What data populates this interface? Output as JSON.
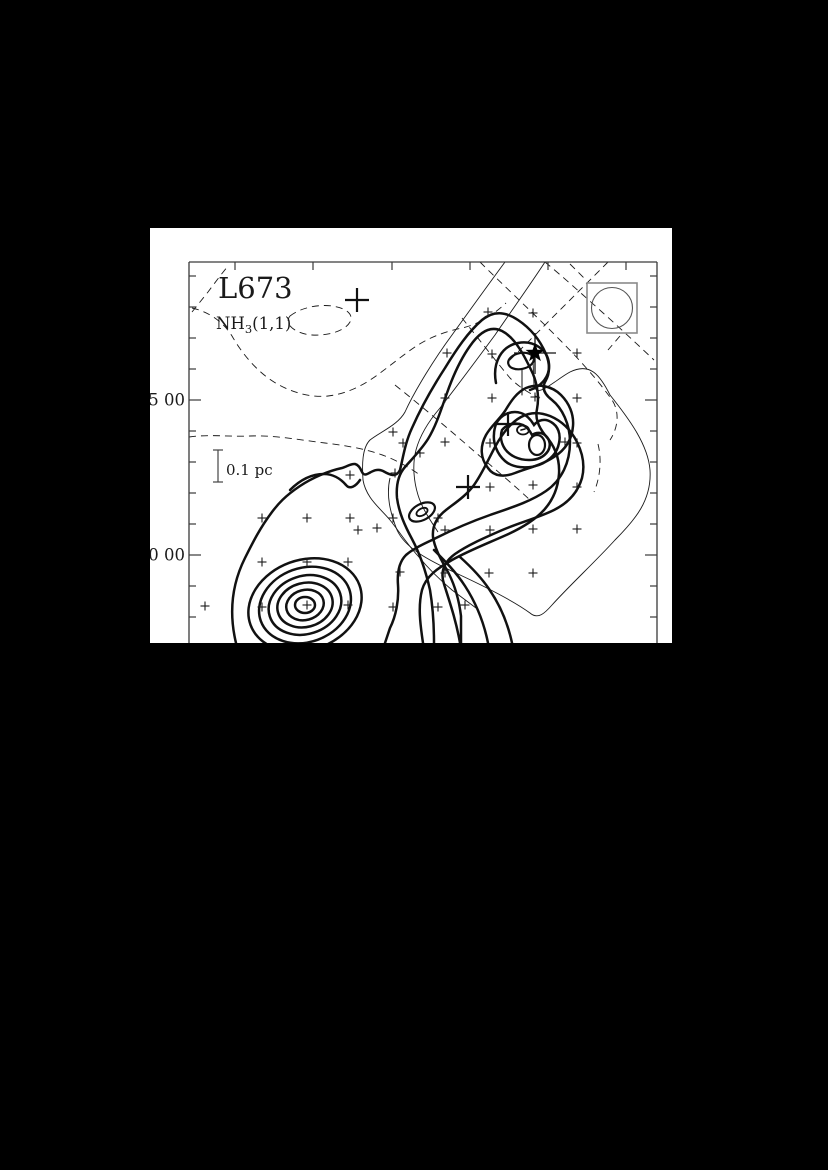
{
  "figure": {
    "title": "L673",
    "subtitle_html": "NH3(1,1)",
    "subtitle_main": "NH",
    "subtitle_sub": "3",
    "subtitle_tail": "(1,1)",
    "scalebar_label": "0.1 pc",
    "axis": {
      "y_tick_labels": [
        {
          "text": "5 00",
          "y": 172
        },
        {
          "text": "0 00",
          "y": 327
        }
      ],
      "y_ticks_minor": [
        48,
        79,
        110,
        141,
        203,
        234,
        265,
        296,
        358,
        389
      ],
      "y_ticks_major": [
        172,
        327
      ],
      "x_ticks_top": [
        85,
        163,
        242,
        320,
        398,
        476
      ]
    },
    "colors": {
      "ink": "#1a1a1a",
      "frame": "#3a3a3a",
      "beam_box": "#8a8a8a",
      "background": "#ffffff",
      "page_background": "#000000"
    }
  },
  "chart_data": {
    "type": "contour_map",
    "title": "L673",
    "molecule_line": "NH3(1,1)",
    "description": "Contour map of NH3(1,1) integrated emission in the dark cloud L673. Thick solid contours trace the NH3 ridge with three condensations: a south-west core, a central-east main core, and a northern core marked by a filled star (embedded source). Thin solid and dashed contours trace extended emission from other tracers. Small plus signs mark the observed grid positions; large plus signs mark reference positions.",
    "y_axis_tick_labels_visible": [
      "5 00",
      "0 00"
    ],
    "scale_bar": {
      "label": "0.1 pc",
      "x": 68,
      "y1": 222,
      "y2": 254
    },
    "beam": {
      "shape": "circle-in-square",
      "box_x": 437,
      "box_y": 55,
      "box_size": 50,
      "circle_r": 20.5
    },
    "large_plus_markers": [
      {
        "x": 207,
        "y": 72
      },
      {
        "x": 358,
        "y": 196
      },
      {
        "x": 318,
        "y": 259
      }
    ],
    "star_marker": {
      "x": 385,
      "y": 125
    },
    "small_plus_markers": [
      [
        338,
        84
      ],
      [
        383,
        85
      ],
      [
        297,
        125
      ],
      [
        342,
        126
      ],
      [
        427,
        125
      ],
      [
        295,
        170
      ],
      [
        342,
        170
      ],
      [
        385,
        169
      ],
      [
        427,
        170
      ],
      [
        243,
        204
      ],
      [
        253,
        215
      ],
      [
        295,
        214
      ],
      [
        340,
        215
      ],
      [
        415,
        214
      ],
      [
        427,
        215
      ],
      [
        270,
        225
      ],
      [
        200,
        247
      ],
      [
        245,
        245
      ],
      [
        340,
        259
      ],
      [
        383,
        257
      ],
      [
        427,
        259
      ],
      [
        112,
        290
      ],
      [
        157,
        290
      ],
      [
        200,
        290
      ],
      [
        243,
        290
      ],
      [
        288,
        290
      ],
      [
        208,
        302
      ],
      [
        227,
        300
      ],
      [
        295,
        302
      ],
      [
        340,
        302
      ],
      [
        383,
        301
      ],
      [
        427,
        301
      ],
      [
        112,
        334
      ],
      [
        157,
        334
      ],
      [
        198,
        334
      ],
      [
        250,
        344
      ],
      [
        295,
        345
      ],
      [
        339,
        345
      ],
      [
        383,
        345
      ],
      [
        55,
        378
      ],
      [
        112,
        379
      ],
      [
        157,
        377
      ],
      [
        198,
        377
      ],
      [
        243,
        379
      ],
      [
        288,
        379
      ],
      [
        315,
        377
      ]
    ],
    "sw_core_center": {
      "x": 155,
      "y": 377,
      "n_contours": 6
    },
    "main_core_center": {
      "x": 371,
      "y": 216,
      "n_contours": 6
    },
    "north_core_center": {
      "x": 371,
      "y": 133
    }
  }
}
